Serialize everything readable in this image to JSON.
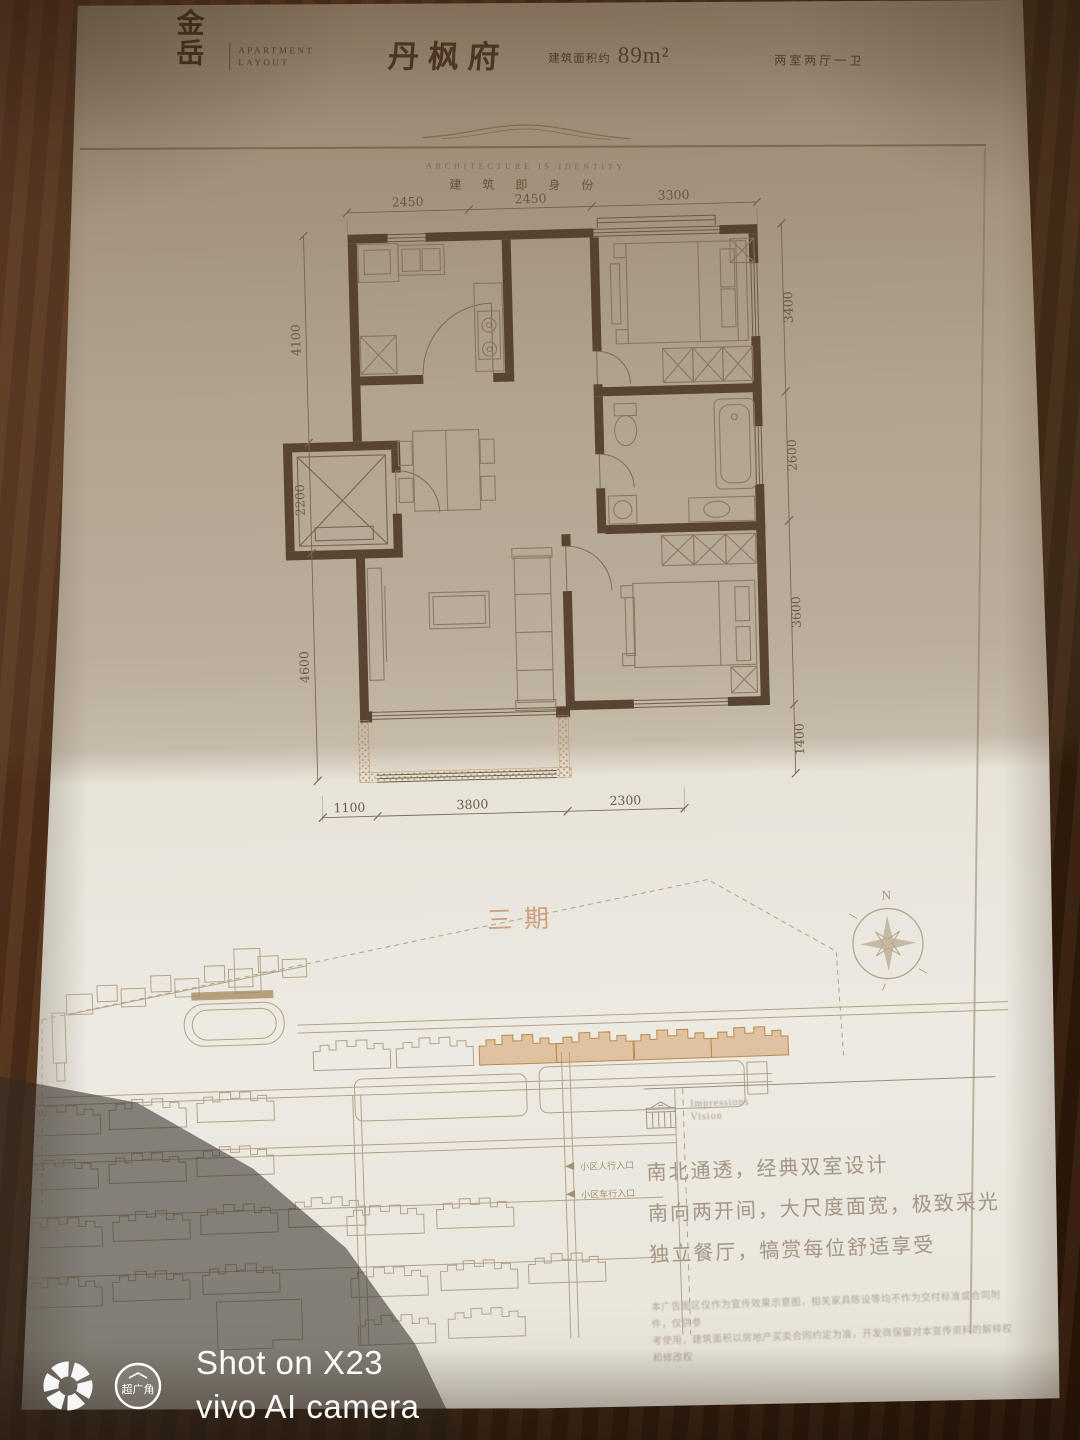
{
  "header": {
    "logo_top": "金",
    "logo_bottom": "岳",
    "logo_caption_line1": "APARTMENT",
    "logo_caption_line2": "LAYOUT",
    "project_name": "丹枫府",
    "area_label": "建筑面积约",
    "area_value": "89m²",
    "unit_type": "两室两厅一卫"
  },
  "tagline": {
    "english": "ARCHITECTURE IS IDENTITY",
    "chinese": "建 筑 即 身 份"
  },
  "floorplan": {
    "dims_top": [
      "2450",
      "2450",
      "3300"
    ],
    "dims_left": [
      "4100",
      "2200",
      "4600"
    ],
    "dims_right": [
      "3400",
      "2600",
      "3600",
      "1400"
    ],
    "dims_bottom": [
      "1100",
      "3800",
      "2300"
    ]
  },
  "siteplan": {
    "phase_label": "三期",
    "compass_north": "N",
    "legend": [
      "小区人行入口",
      "小区车行入口"
    ]
  },
  "info": {
    "brand_line1": "Impressions",
    "brand_line2": "Vision",
    "selling_points": [
      "南北通透，经典双室设计",
      "南向两开间，大尺度面宽，极致采光",
      "独立餐厅，犒赏每位舒适享受"
    ],
    "disclaimer_line1": "本广告图区仅作为宣传效果示意图，相关家具陈设等均不作为交付标准或合同附件，仅供参",
    "disclaimer_line2": "考使用，建筑面积以房地产买卖合同约定为准，开发商保留对本宣传资料的解释权和修改权"
  },
  "watermark": {
    "line1": "Shot on X23",
    "line2": "vivo AI camera",
    "badge": "超广角"
  },
  "colors": {
    "ink": "#54402e",
    "dim_text": "#6e5d49",
    "site_line": "#b3a38a",
    "phase_orange": "#cf9a60",
    "phase_text": "#cf9f80"
  }
}
